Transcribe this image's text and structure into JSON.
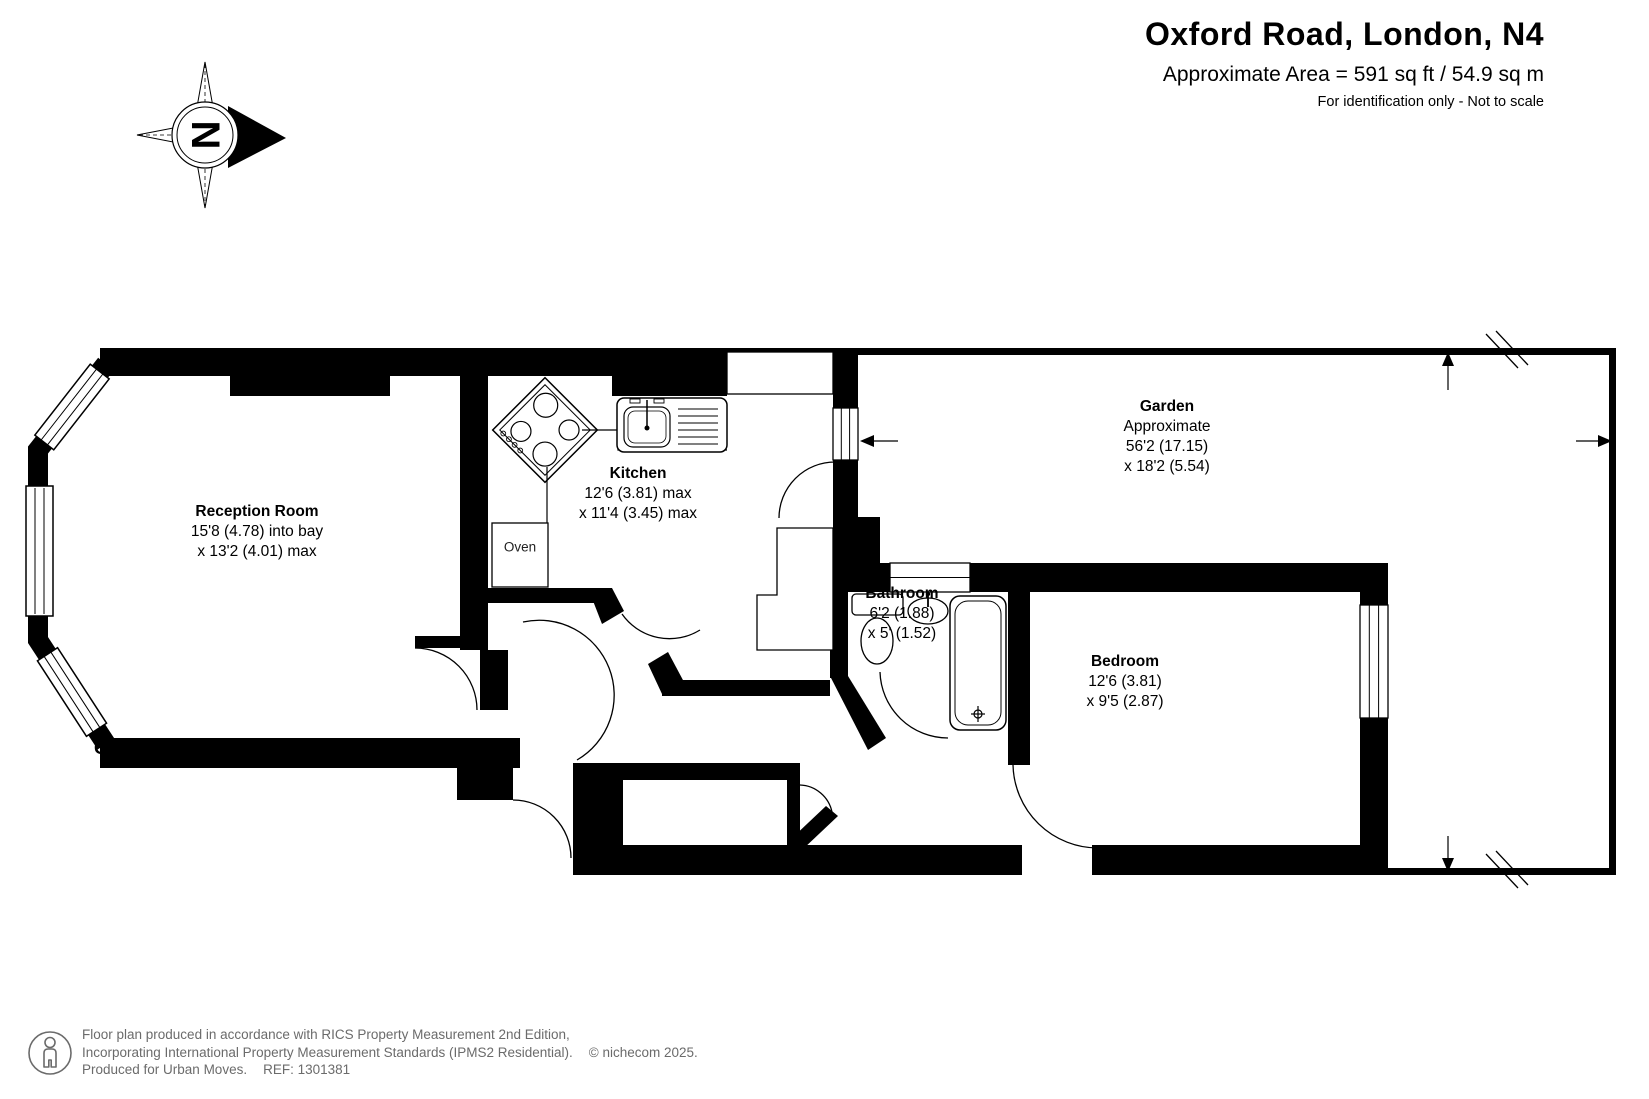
{
  "header": {
    "title": "Oxford Road, London, N4",
    "area_line": "Approximate Area = 591 sq ft / 54.9 sq m",
    "disclaimer": "For identification only - Not to scale"
  },
  "floor": {
    "label": "GROUND FLOOR"
  },
  "compass": {
    "north_letter": "N"
  },
  "rooms": {
    "reception": {
      "name": "Reception Room",
      "line1": "15'8 (4.78) into bay",
      "line2": "x 13'2 (4.01) max"
    },
    "kitchen": {
      "name": "Kitchen",
      "line1": "12'6 (3.81) max",
      "line2": "x 11'4 (3.45) max"
    },
    "garden": {
      "name": "Garden",
      "line1": "Approximate",
      "line2": "56'2 (17.15)",
      "line3": "x 18'2 (5.54)"
    },
    "bathroom": {
      "name": "Bathroom",
      "line1": "6'2 (1.88)",
      "line2": "x 5' (1.52)"
    },
    "bedroom": {
      "name": "Bedroom",
      "line1": "12'6 (3.81)",
      "line2": "x 9'5 (2.87)"
    }
  },
  "fixtures": {
    "oven_label": "Oven"
  },
  "footer": {
    "line1": "Floor plan produced in accordance with RICS Property Measurement 2nd Edition,",
    "line2": "Incorporating International Property Measurement Standards (IPMS2 Residential).",
    "copyright": "© nichecom 2025.",
    "line3": "Produced for Urban Moves.",
    "ref": "REF: 1301381"
  },
  "colors": {
    "wall": "#000000",
    "footer_text": "#6b6b6b"
  }
}
